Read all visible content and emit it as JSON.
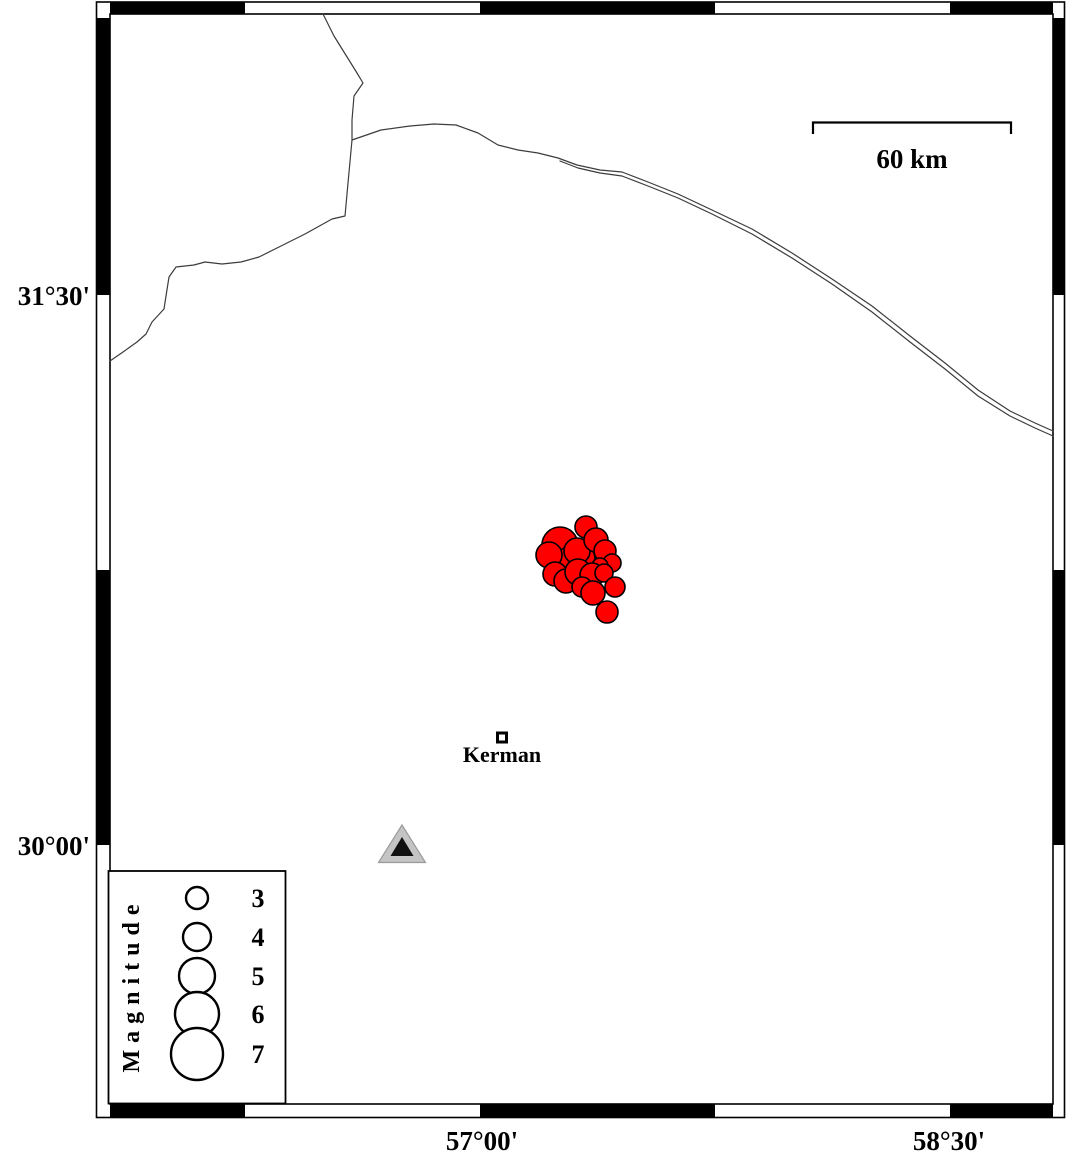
{
  "colors": {
    "background": "#ffffff",
    "frame": "#000000",
    "boundary_line": "#3c3c3c",
    "epicenter_fill": "#ff0000",
    "epicenter_outline": "#000000",
    "station_fill": "#c4c4c4",
    "station_edge": "#9a9a9a",
    "station_inner": "#101010",
    "text": "#000000"
  },
  "map": {
    "axis_labels": {
      "left": [
        {
          "label": "31°30'"
        },
        {
          "label": "30°00'"
        }
      ],
      "bottom": [
        {
          "label": "57°00'"
        },
        {
          "label": "58°30'"
        }
      ]
    },
    "frame": {
      "black_segments_x": [
        [
          110,
          245
        ],
        [
          480,
          715
        ],
        [
          950,
          1053
        ]
      ],
      "black_segments_y": [
        [
          18,
          295
        ],
        [
          570,
          845
        ]
      ]
    },
    "scalebar": {
      "label": "60 km"
    },
    "city": {
      "name": "Kerman"
    },
    "boundary_lines": [
      {
        "name": "boundary-line-west",
        "points": [
          [
            323,
            14
          ],
          [
            334,
            36
          ],
          [
            357,
            73
          ],
          [
            363,
            83
          ],
          [
            354,
            96
          ],
          [
            352,
            120
          ],
          [
            352,
            140
          ],
          [
            348,
            183
          ],
          [
            345,
            216
          ],
          [
            332,
            219
          ],
          [
            305,
            234
          ],
          [
            281,
            246
          ],
          [
            259,
            257
          ],
          [
            241,
            262
          ],
          [
            222,
            264
          ],
          [
            205,
            262
          ],
          [
            194,
            265
          ],
          [
            176,
            267
          ],
          [
            169,
            277
          ],
          [
            166,
            296
          ],
          [
            164,
            309
          ],
          [
            152,
            322
          ],
          [
            146,
            334
          ],
          [
            137,
            342
          ],
          [
            123,
            352
          ],
          [
            110,
            361
          ]
        ]
      },
      {
        "name": "boundary-line-main",
        "points": [
          [
            352,
            140
          ],
          [
            381,
            130
          ],
          [
            410,
            126
          ],
          [
            434,
            124
          ],
          [
            456,
            125
          ],
          [
            478,
            133
          ],
          [
            498,
            145
          ],
          [
            518,
            150
          ],
          [
            538,
            153
          ],
          [
            558,
            158
          ],
          [
            577,
            165
          ],
          [
            600,
            170
          ],
          [
            622,
            172
          ],
          [
            648,
            182
          ],
          [
            678,
            194
          ],
          [
            712,
            210
          ],
          [
            752,
            229
          ],
          [
            792,
            253
          ],
          [
            832,
            279
          ],
          [
            872,
            306
          ],
          [
            910,
            336
          ],
          [
            945,
            363
          ],
          [
            978,
            390
          ],
          [
            1010,
            411
          ],
          [
            1035,
            423
          ],
          [
            1053,
            431
          ]
        ]
      },
      {
        "name": "boundary-line-main-south",
        "points": [
          [
            560,
            161
          ],
          [
            578,
            168
          ],
          [
            600,
            173
          ],
          [
            622,
            176
          ],
          [
            648,
            186
          ],
          [
            678,
            198
          ],
          [
            712,
            214
          ],
          [
            752,
            234
          ],
          [
            792,
            258
          ],
          [
            832,
            284
          ],
          [
            872,
            312
          ],
          [
            910,
            342
          ],
          [
            945,
            369
          ],
          [
            978,
            396
          ],
          [
            1010,
            416
          ],
          [
            1035,
            428
          ],
          [
            1053,
            436
          ]
        ]
      }
    ],
    "earthquakes": [
      {
        "x": 560,
        "y": 545,
        "r": 18
      },
      {
        "x": 579,
        "y": 559,
        "r": 16
      },
      {
        "x": 571,
        "y": 560,
        "r": 14
      },
      {
        "x": 577,
        "y": 551,
        "r": 13
      },
      {
        "x": 586,
        "y": 527,
        "r": 11
      },
      {
        "x": 596,
        "y": 540,
        "r": 12
      },
      {
        "x": 549,
        "y": 555,
        "r": 13
      },
      {
        "x": 605,
        "y": 551,
        "r": 11
      },
      {
        "x": 612,
        "y": 563,
        "r": 9
      },
      {
        "x": 600,
        "y": 566,
        "r": 8
      },
      {
        "x": 555,
        "y": 574,
        "r": 12
      },
      {
        "x": 566,
        "y": 581,
        "r": 12
      },
      {
        "x": 578,
        "y": 572,
        "r": 13
      },
      {
        "x": 592,
        "y": 575,
        "r": 12
      },
      {
        "x": 604,
        "y": 573,
        "r": 9
      },
      {
        "x": 582,
        "y": 587,
        "r": 10
      },
      {
        "x": 593,
        "y": 593,
        "r": 12
      },
      {
        "x": 615,
        "y": 587,
        "r": 10
      },
      {
        "x": 607,
        "y": 612,
        "r": 11
      }
    ]
  },
  "legend": {
    "title": "Magnitude",
    "items": [
      {
        "label": "3",
        "r": 11,
        "cy": 898
      },
      {
        "label": "4",
        "r": 14,
        "cy": 937
      },
      {
        "label": "5",
        "r": 18,
        "cy": 976
      },
      {
        "label": "6",
        "r": 22,
        "cy": 1014
      },
      {
        "label": "7",
        "r": 26,
        "cy": 1054
      }
    ]
  }
}
